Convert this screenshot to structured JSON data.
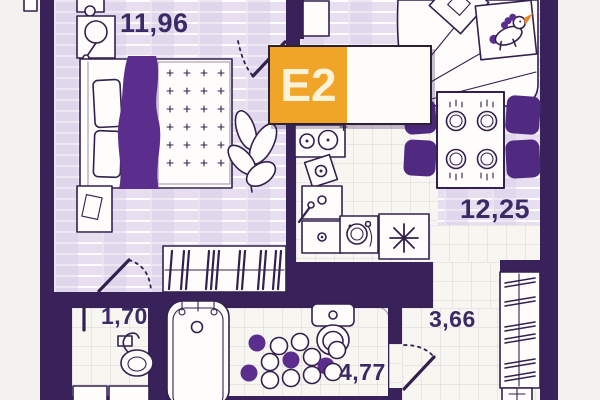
{
  "badge": {
    "code": "E2"
  },
  "rooms": {
    "bedroom": {
      "area": "11,96"
    },
    "kitchen_living": {
      "area": "12,25"
    },
    "closet": {
      "area": "1,70"
    },
    "bathroom": {
      "area": "4,77"
    },
    "hallway": {
      "area": "3,66"
    }
  },
  "furniture_icons": {
    "bedroom": [
      "double-bed-icon",
      "purple-blanket-icon",
      "pillows-icon",
      "nightstand-lamp-icon",
      "nightstand-icon",
      "plant-icon",
      "wardrobe-hangers-icon",
      "door-swing-icon"
    ],
    "kitchen_living": [
      "sofa-bed-icon",
      "pillow-icon",
      "unicorn-toy-icon",
      "dining-table-icon",
      "plate-icon",
      "chair-icon",
      "cooktop-icon",
      "kettle-icon",
      "kitchen-sink-icon",
      "washing-machine-icon",
      "counter-star-icon"
    ],
    "closet": [
      "hand-basin-icon",
      "cabinet-icon"
    ],
    "bathroom": [
      "bathtub-icon",
      "toilet-icon",
      "pebble-rug-icon",
      "door-swing-icon"
    ],
    "hallway": [
      "wardrobe-rail-icon",
      "hanger-icon",
      "shoe-box-icon"
    ]
  },
  "colors": {
    "wall": "#392159",
    "floor_brick": "#E7DFF0",
    "floor_tile": "#F8F6F1",
    "accent_purple": "#5B2D8C",
    "chair_purple": "#4F2A80",
    "orange": "#F0A428",
    "ink": "#33204F",
    "label_text": "#3B2A66",
    "outside": "#F3F2EF",
    "badge_text": "#FBF2D8"
  }
}
